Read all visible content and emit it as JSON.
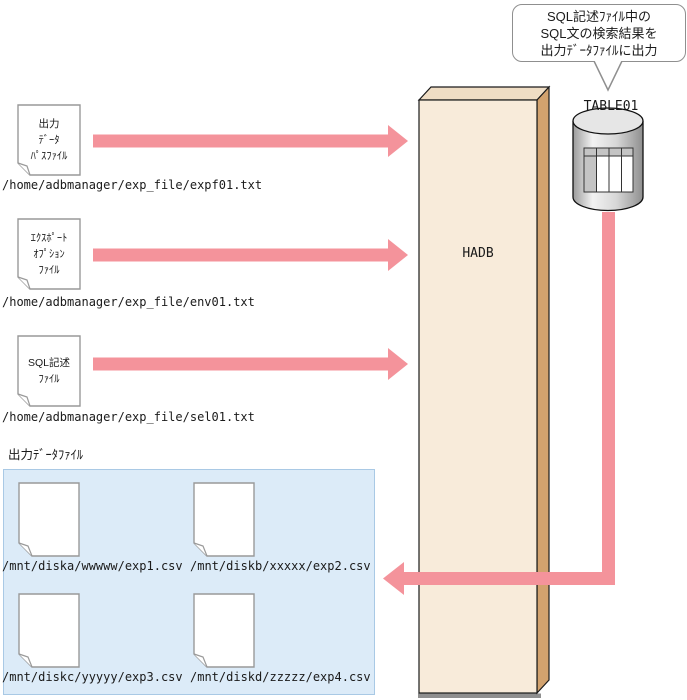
{
  "callout": {
    "lines": [
      "SQL記述ﾌｧｲﾙ中の",
      "SQL文の検索結果を",
      "出力ﾃﾞｰﾀﾌｧｲﾙに出力"
    ]
  },
  "database": {
    "table_label": "TABLE01"
  },
  "engine": {
    "label": "HADB"
  },
  "input_files": [
    {
      "label_lines": [
        "出力",
        "ﾃﾞｰﾀ",
        "ﾊﾟｽﾌｧｲﾙ"
      ],
      "path": "/home/adbmanager/exp_file/expf01.txt"
    },
    {
      "label_lines": [
        "ｴｸｽﾎﾟｰﾄ",
        "ｵﾌﾟｼｮﾝ",
        "ﾌｧｲﾙ"
      ],
      "path": "/home/adbmanager/exp_file/env01.txt"
    },
    {
      "label_lines": [
        "SQL記述",
        "ﾌｧｲﾙ"
      ],
      "path": "/home/adbmanager/exp_file/sel01.txt"
    }
  ],
  "output_area": {
    "label": "出力ﾃﾞｰﾀﾌｧｲﾙ",
    "files": [
      {
        "path": "/mnt/diska/wwwww/exp1.csv"
      },
      {
        "path": "/mnt/diskb/xxxxx/exp2.csv"
      },
      {
        "path": "/mnt/diskc/yyyyy/exp3.csv"
      },
      {
        "path": "/mnt/diskd/zzzzz/exp4.csv"
      }
    ]
  },
  "colors": {
    "arrow": "#F4939B",
    "pillar_face": "#F8EBDA",
    "pillar_top": "#EFDDC4",
    "pillar_side": "#D2A26E",
    "output_area_bg": "#DCEBF8",
    "output_area_border": "#A9C9E5"
  }
}
